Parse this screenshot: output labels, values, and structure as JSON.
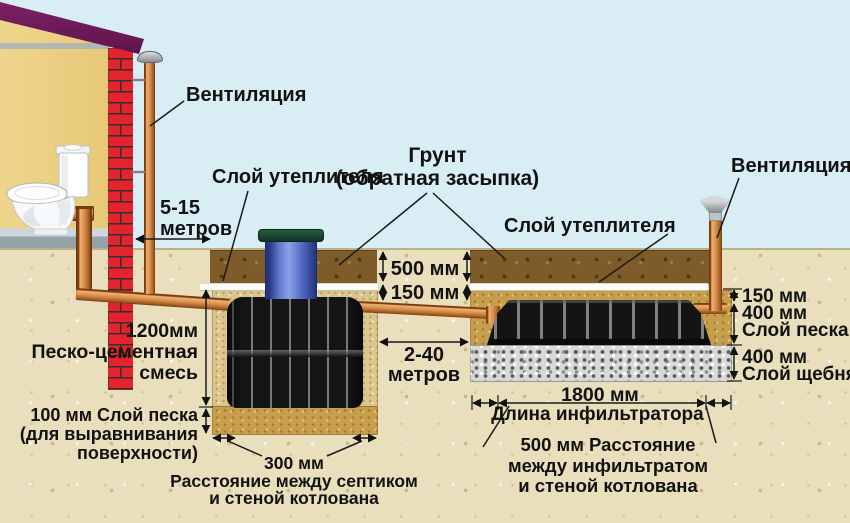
{
  "diagram_title": "Septic tank and infiltrator installation scheme",
  "labels": {
    "vent_left": "Вентиляция",
    "insulation_left": "Слой утеплителя",
    "ground_line1": "Грунт",
    "ground_line2": "(обратная засыпка)",
    "insulation_right": "Слой утеплителя",
    "vent_right": "Вентиляция",
    "house_distance_line1": "5-15",
    "house_distance_line2": "метров",
    "depth_500": "500 мм",
    "depth_150": "150 мм",
    "septic_depth": "1200мм",
    "sand_cement_line1": "Песко-цементная",
    "sand_cement_line2": "смесь",
    "sand_bottom_line1": "100 мм Слой песка",
    "sand_bottom_line2": "(для выравнивания",
    "sand_bottom_line3": "поверхности)",
    "septic_gap_value": "300 мм",
    "septic_gap_line1": "Расстояние между септиком",
    "septic_gap_line2": "и стеной котлована",
    "pipe_distance_line1": "2-40",
    "pipe_distance_line2": "метров",
    "inf_150": "150 мм",
    "inf_sand_line1": "400 мм",
    "inf_sand_line2": "Слой песка",
    "inf_gravel_line1": "400 мм",
    "inf_gravel_line2": "Слой щебня",
    "inf_length_value": "1800 мм",
    "inf_length_caption": "Длина инфильтратора",
    "inf_gap_line1": "500 мм Расстояние",
    "inf_gap_line2": "между инфильтратом",
    "inf_gap_line3": "и стеной котлована"
  },
  "colors": {
    "sky": "#d9edf4",
    "ground": "#e9dfbd",
    "topsoil": "#7d5c2a",
    "sand": "#c79f4c",
    "gravel": "#d8d8d6",
    "insulation": "#fbfbf8",
    "pipe": "#d78c49",
    "tank": "#151515",
    "neck": "#4d64c0",
    "lid": "#0f3422",
    "wall": "#ecd083",
    "roof": "#6e1c5c",
    "brick": "#e3242f",
    "floor": "#95a2aa",
    "text": "#121212"
  }
}
